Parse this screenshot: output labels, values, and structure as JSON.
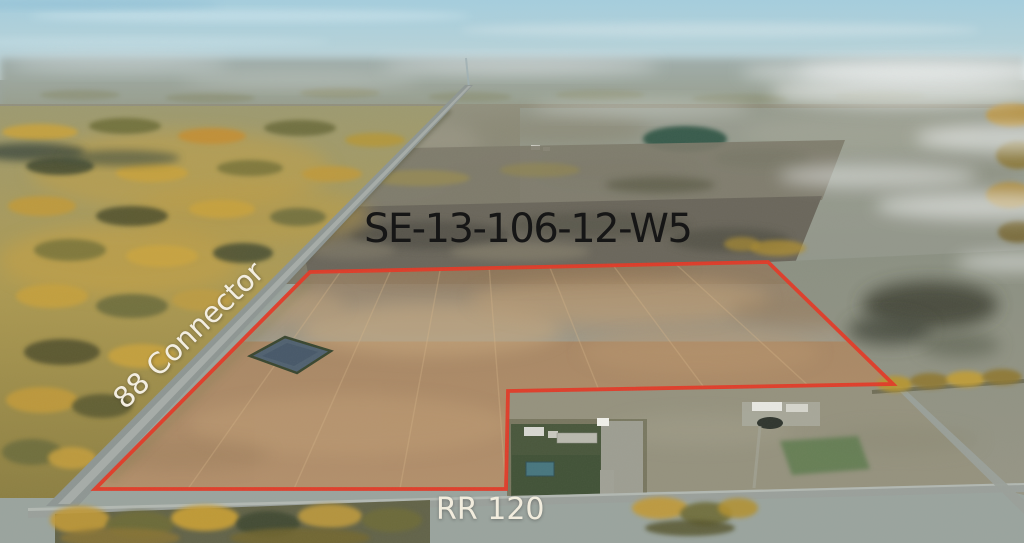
{
  "annotations": {
    "legal_description": "SE-13-106-12-W5",
    "road_labels": [
      {
        "id": "88-connector",
        "label": "88 Connector"
      },
      {
        "id": "rr-120",
        "label": "RR 120"
      }
    ]
  },
  "scene": {
    "type": "aerial-photo-of-farm-parcel",
    "season": "autumn",
    "boundary_color": "#e23a27",
    "legal_text_color": "#161616",
    "road_text_color": "#f3eee1"
  }
}
